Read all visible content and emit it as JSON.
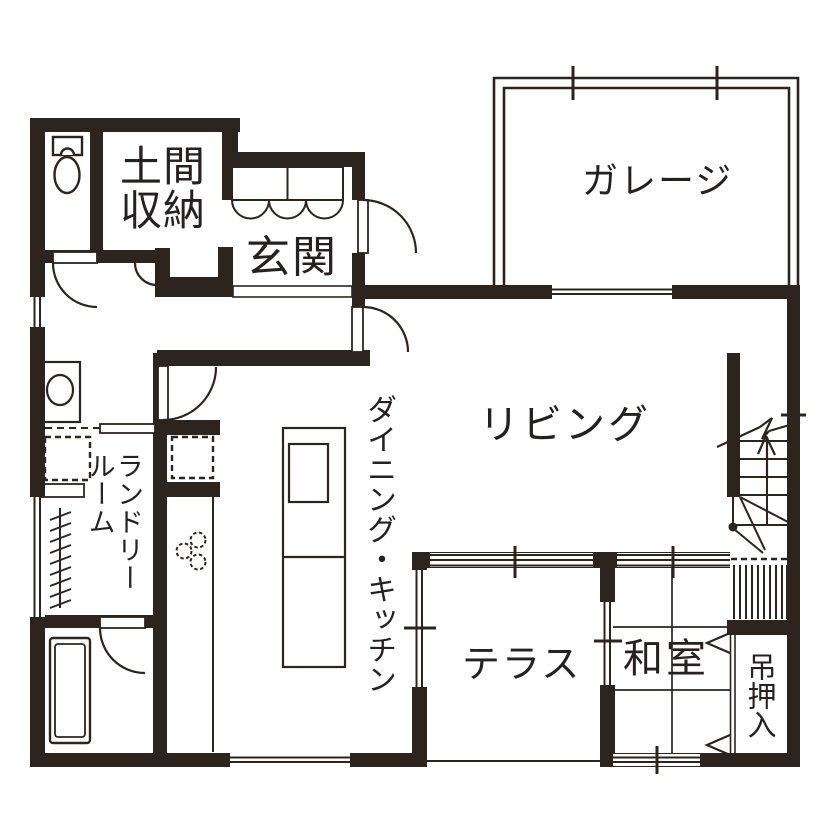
{
  "page": {
    "background": "#ffffff",
    "ink": "#2d241e",
    "text_color": "#262120"
  },
  "rooms": {
    "garage": {
      "label": "ガレージ"
    },
    "doma_storage": {
      "label": "土間収納"
    },
    "genkan": {
      "label": "玄関"
    },
    "living": {
      "label": "リビング"
    },
    "dining_kitchen": {
      "label": "ダイニング・キッチン"
    },
    "laundry": {
      "label": "ランドリールーム"
    },
    "terrace": {
      "label": "テラス"
    },
    "washitsu": {
      "label": "和室"
    },
    "tsuri_oshiire": {
      "label": "吊押入"
    }
  }
}
